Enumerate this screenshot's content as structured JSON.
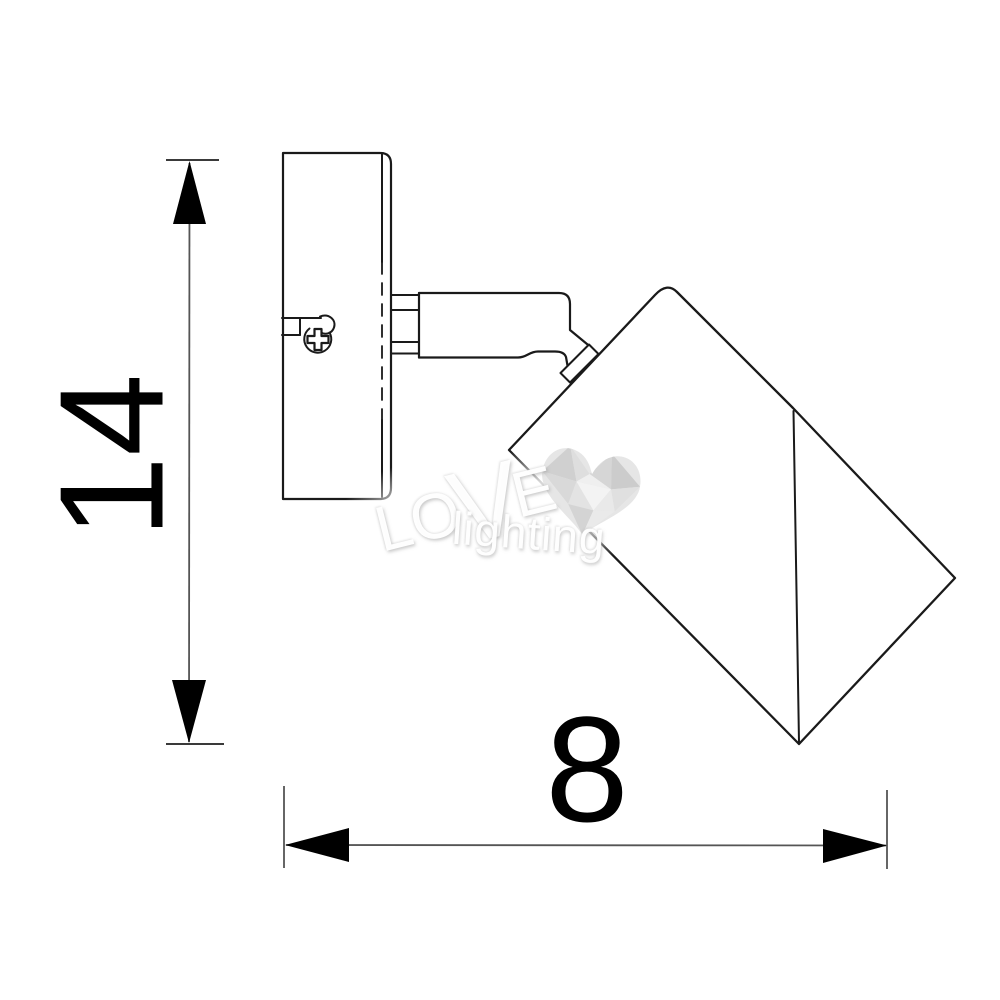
{
  "labels": {
    "height_value": "14",
    "width_value": "8"
  },
  "colors": {
    "line": "#1a1a1a",
    "dimension_line": "#4f4f4f",
    "tick": "#3a3a3a",
    "arrow": "#000000",
    "label_text": "#000000",
    "background": "#ffffff"
  },
  "watermark": {
    "word_part_lo": "LO",
    "word_part_v": "V",
    "word_part_e": "E",
    "word_lighting": "lighting",
    "heart_colors": [
      "#d0d0d0",
      "#dedede",
      "#d6d6d6",
      "#cccccc",
      "#efefef",
      "#d9d9d9",
      "#e3e3e3",
      "#f3f3f3",
      "#e0e0e0",
      "#e9e9e9",
      "#d4d4d4",
      "#eaeaea"
    ]
  }
}
